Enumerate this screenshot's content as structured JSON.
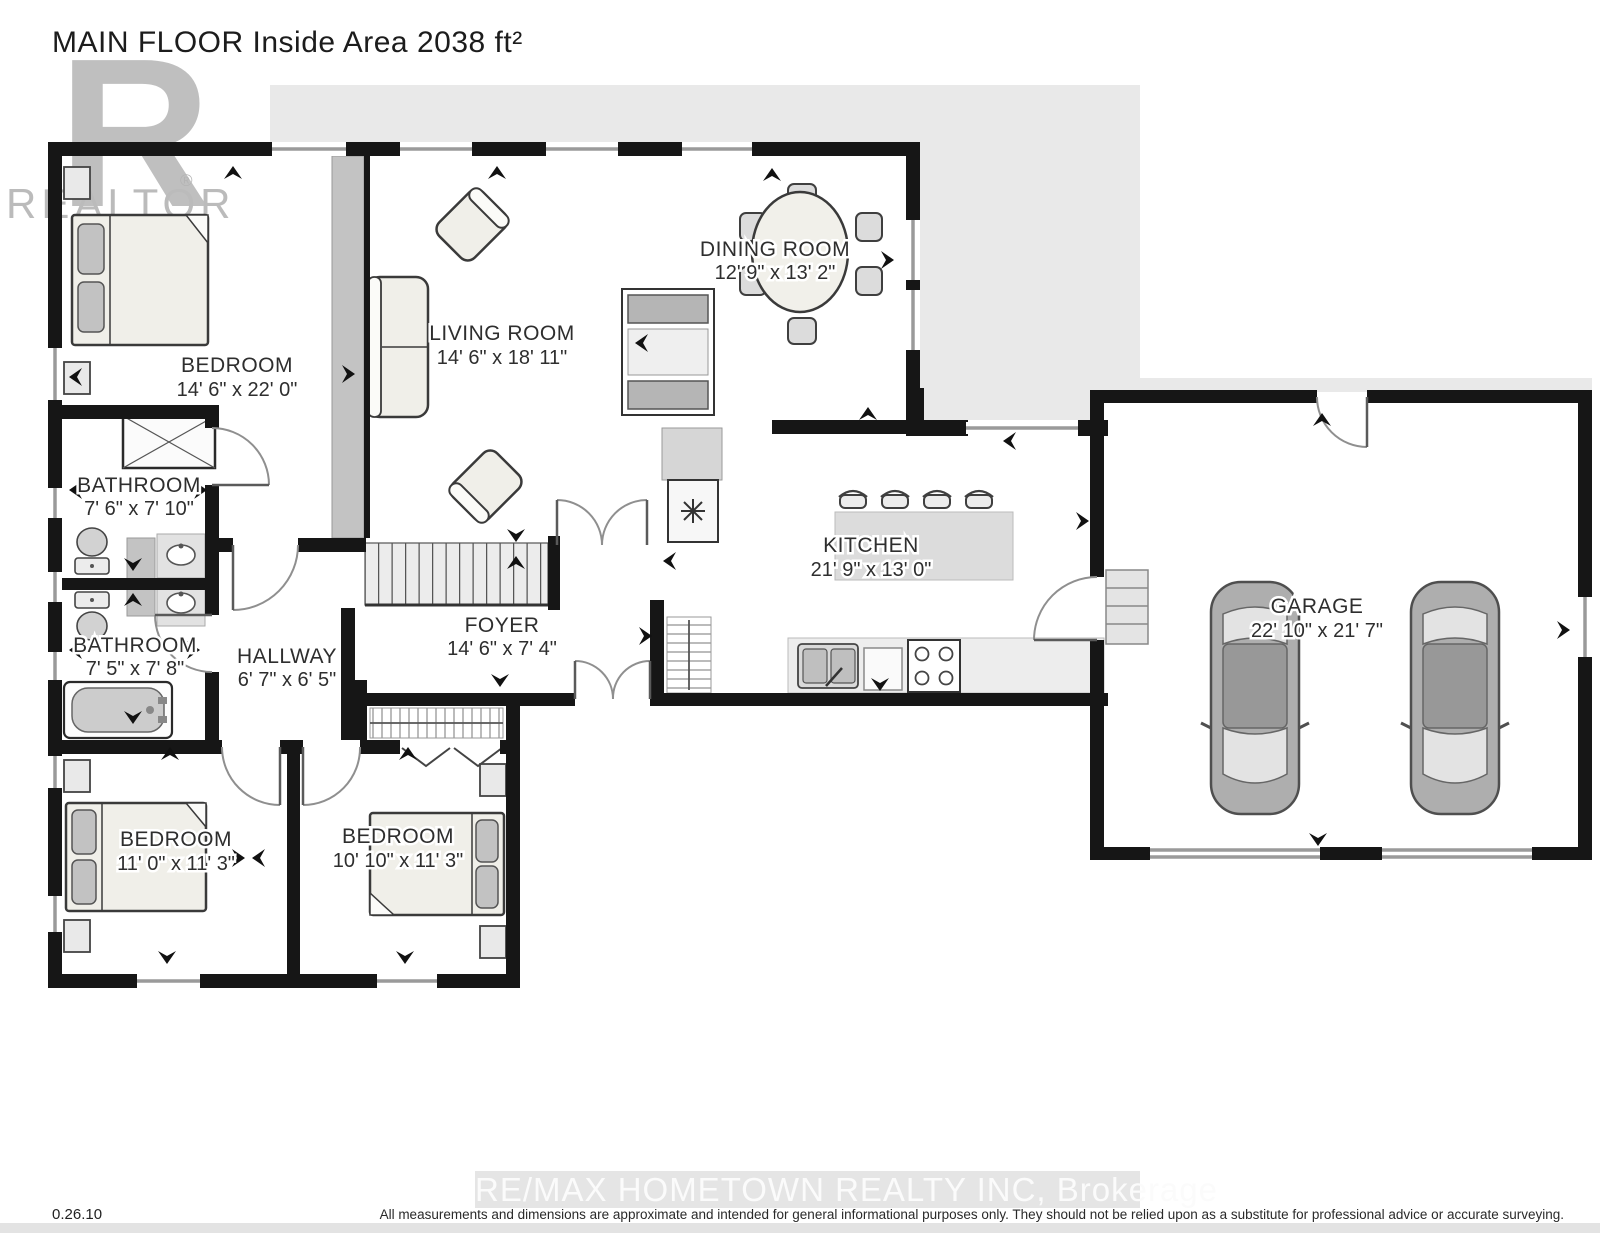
{
  "title": "MAIN FLOOR Inside Area 2038 ft²",
  "watermark": {
    "logo_letter": "R",
    "logo_text": "REALTOR",
    "logo_reg": "®",
    "brokerage": "RE/MAX HOMETOWN REALTY INC, Brokerage"
  },
  "footer": {
    "version": "0.26.10",
    "disclaimer": "All measurements and dimensions are approximate and intended for general informational purposes only. They should not be relied upon as a substitute for professional advice or accurate surveying."
  },
  "rooms": {
    "bedroom_master": {
      "name": "BEDROOM",
      "dims": "14' 6\" x 22' 0\""
    },
    "living_room": {
      "name": "LIVING ROOM",
      "dims": "14' 6\" x 18' 11\""
    },
    "dining_room": {
      "name": "DINING ROOM",
      "dims": "12' 9\" x 13' 2\""
    },
    "bathroom_upper": {
      "name": "BATHROOM",
      "dims": "7' 6\" x 7' 10\""
    },
    "bathroom_lower": {
      "name": "BATHROOM",
      "dims": "7' 5\" x 7' 8\""
    },
    "hallway": {
      "name": "HALLWAY",
      "dims": "6' 7\" x 6' 5\""
    },
    "foyer": {
      "name": "FOYER",
      "dims": "14' 6\" x 7' 4\""
    },
    "kitchen": {
      "name": "KITCHEN",
      "dims": "21' 9\" x 13' 0\""
    },
    "garage": {
      "name": "GARAGE",
      "dims": "22' 10\" x 21' 7\""
    },
    "bedroom_left": {
      "name": "BEDROOM",
      "dims": "11' 0\" x 11' 3\""
    },
    "bedroom_right": {
      "name": "BEDROOM",
      "dims": "10' 10\" x 11' 3\""
    }
  },
  "colors": {
    "wall": "#161616",
    "backdrop": "#e9e9e9",
    "half_wall": "#c3c3c3",
    "label_text": "#2e2e2e"
  }
}
